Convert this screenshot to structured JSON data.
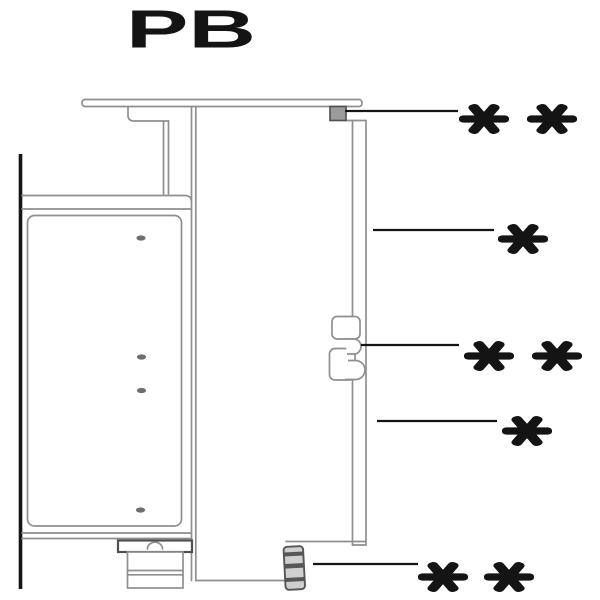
{
  "title": "PB",
  "annotations": [
    {
      "id": "worktop-fixing",
      "label": "* *"
    },
    {
      "id": "back-panel-upper",
      "label": "*"
    },
    {
      "id": "panel-clip",
      "label": "* *"
    },
    {
      "id": "back-panel-lower",
      "label": "*"
    },
    {
      "id": "base-fixing",
      "label": "* *"
    }
  ]
}
